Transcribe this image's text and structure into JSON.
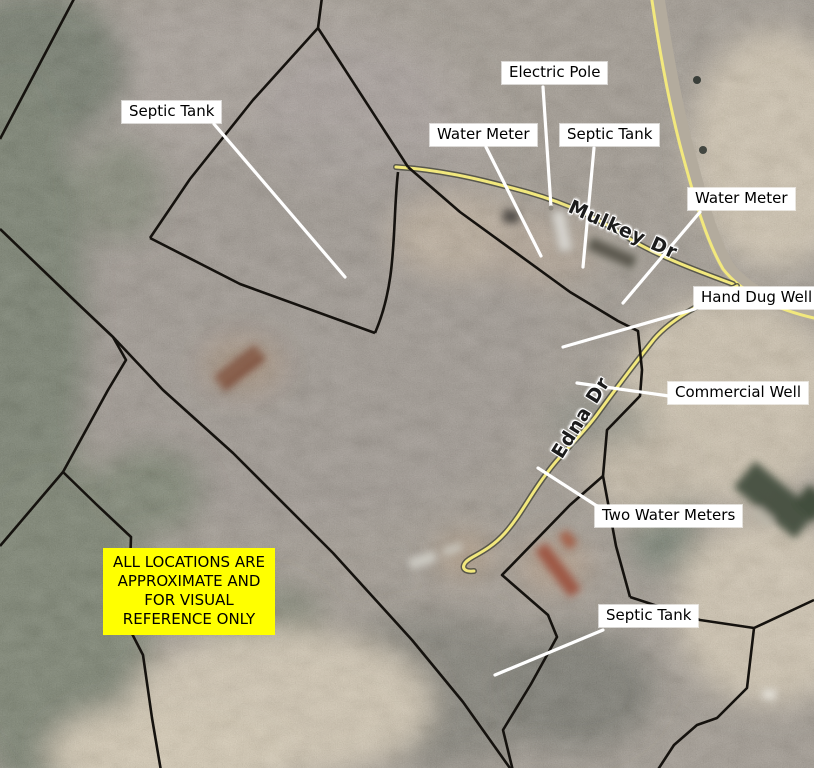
{
  "map": {
    "type": "annotated-aerial-parcel-map",
    "disclaimer": {
      "line1": "ALL LOCATIONS ARE",
      "line2": "APPROXIMATE AND",
      "line3": "FOR VISUAL",
      "line4": "REFERENCE ONLY"
    },
    "roads": {
      "mulkey": "Mulkey Dr",
      "edna": "Edna Dr"
    },
    "callouts": {
      "septic_tank_nw": "Septic Tank",
      "electric_pole": "Electric Pole",
      "water_meter_w": "Water Meter",
      "septic_tank_n": "Septic Tank",
      "water_meter_e": "Water Meter",
      "hand_dug_well": "Hand Dug Well",
      "commercial_well": "Commercial Well",
      "two_water_meters": "Two Water Meters",
      "septic_tank_s": "Septic Tank"
    },
    "colors": {
      "label_bg": "#ffffff",
      "label_text": "#000000",
      "leader": "#ffffff",
      "road_stripe": "#f2e87d",
      "road_casing": "#4a4a40",
      "highway_surface": "#b3ab9d",
      "parcel_line": "#15120e",
      "disclaimer_bg": "#ffff00",
      "disclaimer_text": "#000000",
      "road_label_text": "#1c1c1c"
    }
  }
}
